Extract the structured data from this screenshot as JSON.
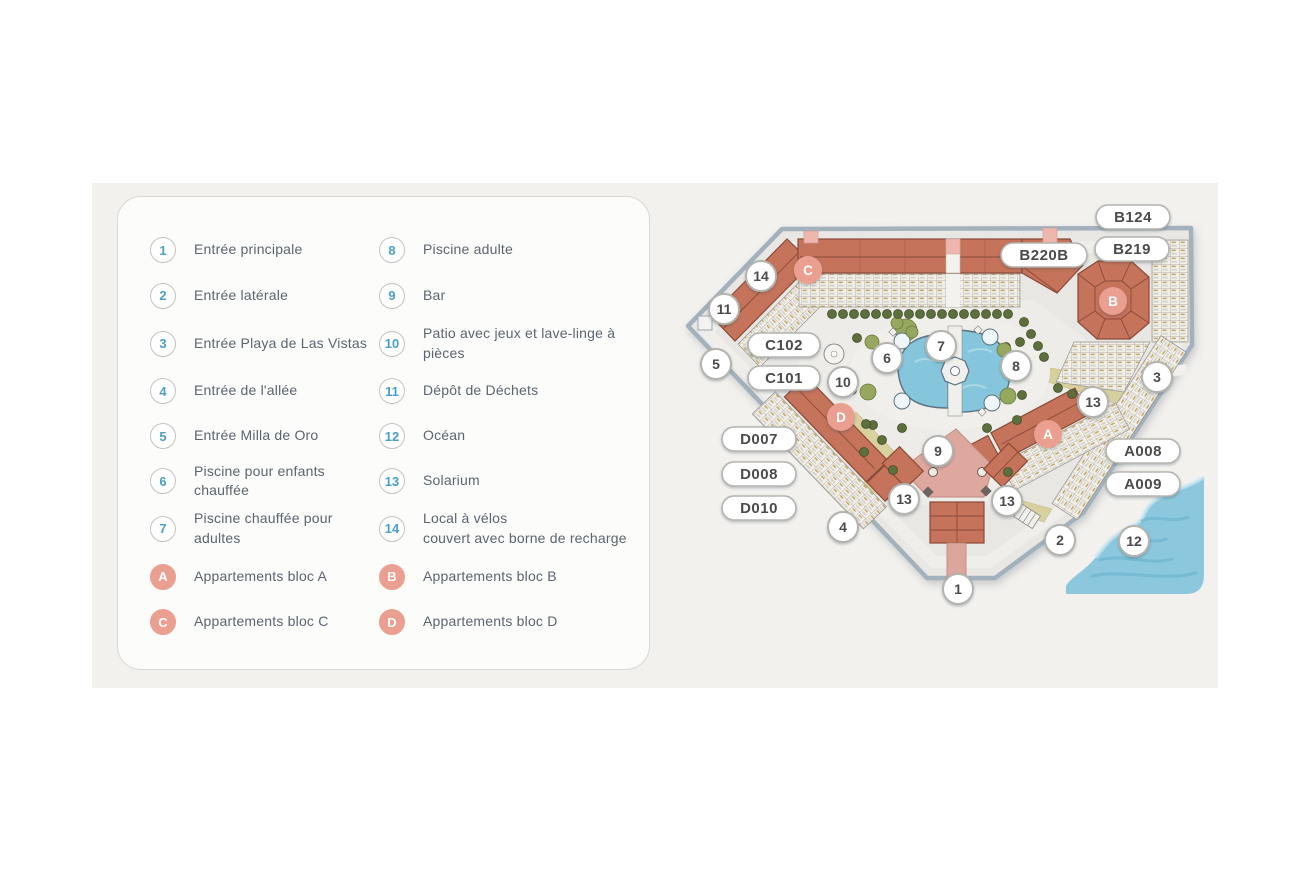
{
  "legend": {
    "items": [
      {
        "num": "1",
        "label": "Entrée principale"
      },
      {
        "num": "2",
        "label": "Entrée latérale"
      },
      {
        "num": "3",
        "label": "Entrée Playa de Las Vistas"
      },
      {
        "num": "4",
        "label": "Entrée de l'allée"
      },
      {
        "num": "5",
        "label": "Entrée Milla de Oro"
      },
      {
        "num": "6",
        "label": "Piscine pour enfants chauffée"
      },
      {
        "num": "7",
        "label": "Piscine chauffée pour adultes"
      },
      {
        "num": "8",
        "label": "Piscine adulte"
      },
      {
        "num": "9",
        "label": "Bar"
      },
      {
        "num": "10",
        "label": "Patio avec jeux et lave-linge à\npièces"
      },
      {
        "num": "11",
        "label": "Dépôt de Déchets"
      },
      {
        "num": "12",
        "label": "Océan"
      },
      {
        "num": "13",
        "label": "Solarium"
      },
      {
        "num": "14",
        "label": "Local à vélos\ncouvert avec borne de recharge"
      }
    ],
    "blocks": [
      {
        "letter": "A",
        "label": "Appartements bloc A"
      },
      {
        "letter": "B",
        "label": "Appartements bloc B"
      },
      {
        "letter": "C",
        "label": "Appartements bloc C"
      },
      {
        "letter": "D",
        "label": "Appartements bloc D"
      }
    ]
  },
  "map": {
    "unit_tags": [
      {
        "label": "B124",
        "x": 1133,
        "y": 217,
        "w": 74
      },
      {
        "label": "B219",
        "x": 1132,
        "y": 249,
        "w": 74
      },
      {
        "label": "B220B",
        "x": 1044,
        "y": 255,
        "w": 86
      },
      {
        "label": "C102",
        "x": 784,
        "y": 345,
        "w": 72
      },
      {
        "label": "C101",
        "x": 784,
        "y": 378,
        "w": 72
      },
      {
        "label": "D007",
        "x": 759,
        "y": 439,
        "w": 74
      },
      {
        "label": "D008",
        "x": 759,
        "y": 474,
        "w": 74
      },
      {
        "label": "D010",
        "x": 759,
        "y": 508,
        "w": 74
      },
      {
        "label": "A008",
        "x": 1143,
        "y": 451,
        "w": 74
      },
      {
        "label": "A009",
        "x": 1143,
        "y": 484,
        "w": 74
      }
    ],
    "block_badges": [
      {
        "letter": "C",
        "x": 808,
        "y": 270
      },
      {
        "letter": "B",
        "x": 1113,
        "y": 301
      },
      {
        "letter": "D",
        "x": 841,
        "y": 417
      },
      {
        "letter": "A",
        "x": 1048,
        "y": 434
      }
    ],
    "markers": [
      {
        "num": "1",
        "x": 958,
        "y": 589
      },
      {
        "num": "2",
        "x": 1060,
        "y": 540
      },
      {
        "num": "3",
        "x": 1157,
        "y": 377
      },
      {
        "num": "4",
        "x": 843,
        "y": 527
      },
      {
        "num": "5",
        "x": 716,
        "y": 364
      },
      {
        "num": "6",
        "x": 887,
        "y": 358
      },
      {
        "num": "7",
        "x": 941,
        "y": 346
      },
      {
        "num": "8",
        "x": 1016,
        "y": 366
      },
      {
        "num": "9",
        "x": 938,
        "y": 451
      },
      {
        "num": "10",
        "x": 843,
        "y": 382
      },
      {
        "num": "11",
        "x": 724,
        "y": 309
      },
      {
        "num": "12",
        "x": 1134,
        "y": 541
      },
      {
        "num": "13",
        "x": 1093,
        "y": 402
      },
      {
        "num": "13",
        "x": 1007,
        "y": 501
      },
      {
        "num": "13",
        "x": 904,
        "y": 499
      },
      {
        "num": "14",
        "x": 761,
        "y": 276
      }
    ]
  },
  "colors": {
    "accent_blue": "#4aa0c6",
    "badge_salmon": "#eb9f90",
    "legend_text": "#5b6570",
    "roof_terracotta": "#c5735a",
    "pool_blue": "#86c6dd",
    "ocean_blue": "#8cc8dd",
    "plaza_pink": "#dfa89f",
    "map_ground": "#e8e7e3",
    "map_outline": "#a2b1bc",
    "panel_background": "#f2f1ee"
  }
}
